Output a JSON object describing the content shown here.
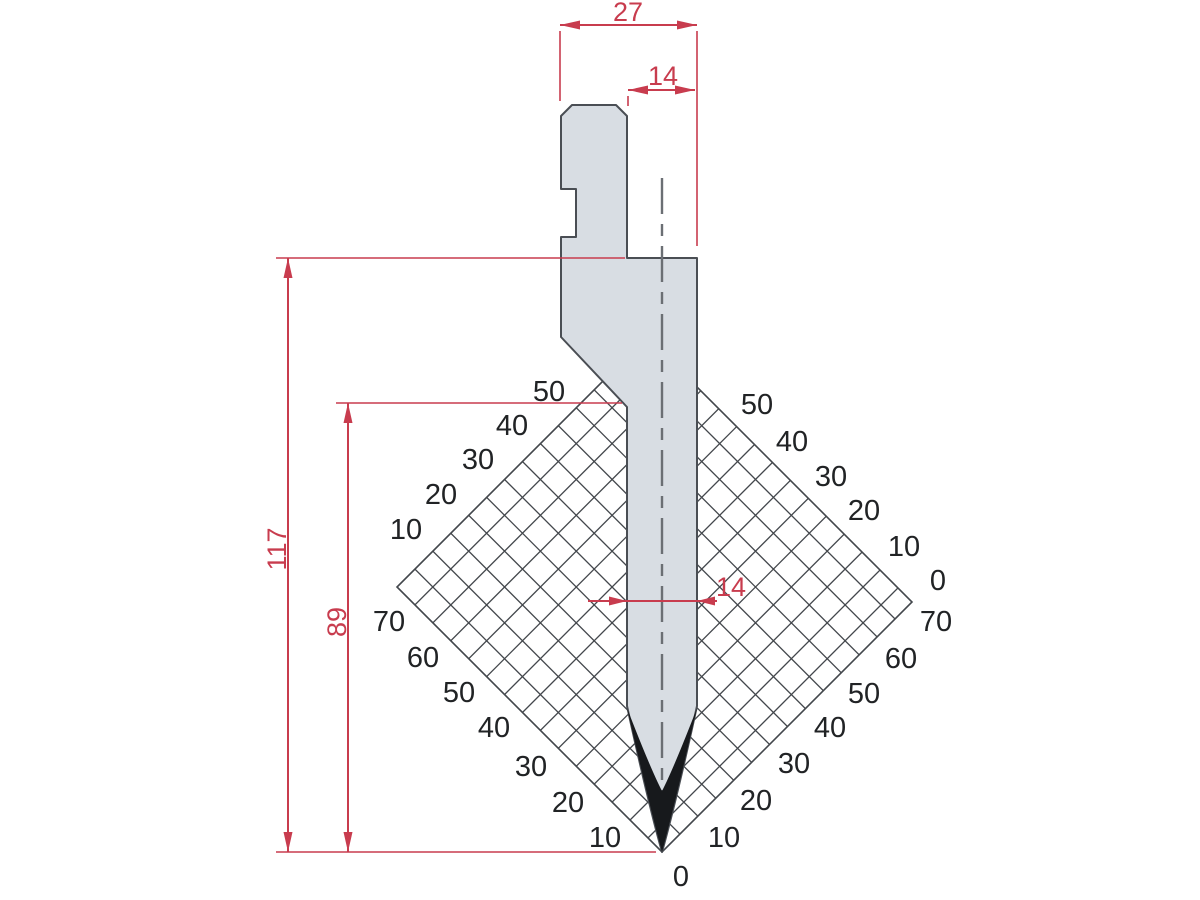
{
  "colors": {
    "dimension_red": "#c83c4e",
    "punch_fill": "#d8dde3",
    "punch_outline": "#4a4e54",
    "tip_black": "#17191c",
    "grid_line": "#43474c",
    "grid_label": "#212325"
  },
  "dimensions": {
    "top_width": "27",
    "tang_width": "14",
    "total_height": "117",
    "working_height": "89",
    "blade_thickness": "14"
  },
  "grid_scale": {
    "upper_left": [
      {
        "t": "50",
        "x": 549,
        "y": 391
      },
      {
        "t": "40",
        "x": 512,
        "y": 425
      },
      {
        "t": "30",
        "x": 478,
        "y": 459
      },
      {
        "t": "20",
        "x": 441,
        "y": 494
      },
      {
        "t": "10",
        "x": 406,
        "y": 529
      }
    ],
    "lower_left": [
      {
        "t": "70",
        "x": 389,
        "y": 621
      },
      {
        "t": "60",
        "x": 423,
        "y": 657
      },
      {
        "t": "50",
        "x": 459,
        "y": 692
      },
      {
        "t": "40",
        "x": 494,
        "y": 727
      },
      {
        "t": "30",
        "x": 531,
        "y": 766
      },
      {
        "t": "20",
        "x": 568,
        "y": 802
      },
      {
        "t": "10",
        "x": 605,
        "y": 837
      }
    ],
    "upper_right": [
      {
        "t": "50",
        "x": 757,
        "y": 404
      },
      {
        "t": "40",
        "x": 792,
        "y": 441
      },
      {
        "t": "30",
        "x": 831,
        "y": 476
      },
      {
        "t": "20",
        "x": 864,
        "y": 510
      },
      {
        "t": "10",
        "x": 904,
        "y": 546
      },
      {
        "t": "0",
        "x": 938,
        "y": 580
      }
    ],
    "lower_right": [
      {
        "t": "70",
        "x": 936,
        "y": 621
      },
      {
        "t": "60",
        "x": 901,
        "y": 658
      },
      {
        "t": "50",
        "x": 864,
        "y": 693
      },
      {
        "t": "40",
        "x": 830,
        "y": 727
      },
      {
        "t": "30",
        "x": 794,
        "y": 763
      },
      {
        "t": "20",
        "x": 756,
        "y": 800
      },
      {
        "t": "10",
        "x": 724,
        "y": 837
      }
    ],
    "origin": {
      "t": "0",
      "x": 681,
      "y": 876
    }
  },
  "grid_geometry": {
    "diamond": [
      [
        647,
        337
      ],
      [
        912,
        602
      ],
      [
        662,
        852
      ],
      [
        397,
        587
      ]
    ],
    "c_range": [
      984,
      1516
    ],
    "d_range": [
      -190,
      312
    ],
    "step": 35.85
  }
}
